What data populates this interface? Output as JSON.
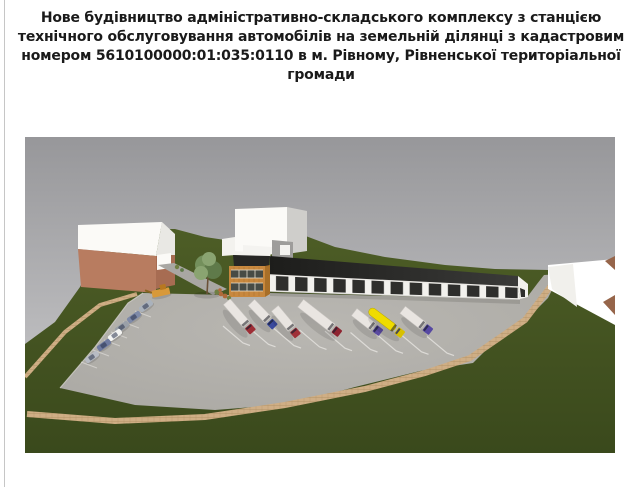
{
  "title": {
    "text": "Нове будівництво адміністративно-складського комплексу з станцією технічного обслуговування автомобілів на земельній ділянці з кадастровим номером 5610100000:01:035:0110 в м. Рівному, Рівненської територіальної громади",
    "lines": [
      "Нове будівництво адміністративно-складського комплексу з станцією",
      "технічного обслуговування автомобілів на земельній ділянці з кадастровим",
      "номером 5610100000:01:035:0110 в м. Рівному, Рівненської територіальної",
      "громади"
    ]
  },
  "render": {
    "description": "3D site visualization: administrative building with wooden facade, long warehouse with dark roof and dark gate panels, truck parking bays with seven trucks, car parking with six cars and a loader, neighboring white massing buildings, green landscaped slopes and paved paths",
    "vehicle_counts": {
      "trucks": 7,
      "cars": 6,
      "loaders": 1
    },
    "colors": {
      "sky_top": "#97979a",
      "sky_bottom": "#bfbfc1",
      "grass_top": "#4d5d26",
      "grass_bottom": "#3a491c",
      "lot_center": "#b9b7b2",
      "lot_edge": "#aaa8a3",
      "path_tan": "#cfae85",
      "path_joint": "#a8895e",
      "path_gray": "#a9a7a3",
      "curb_white": "#d3d1cc",
      "brick": "#b87c60",
      "brick_side": "#a76c52",
      "white_bldg": "#fbfaf7",
      "white_bldg_shade": "#cfcecb",
      "gray_bldg": "#9e9d9b",
      "admin_wood": "#c8883e",
      "admin_wood_side": "#a86f28",
      "roof_left": "#1d1d1b",
      "roof_right": "#3a3a38",
      "wall_white": "#f2f1ed",
      "panel_dark": "#2e2e2c",
      "window_dark": "#474b45",
      "tree_light": "#8aa471",
      "tree_mid": "#74905c",
      "tree_dark": "#5f7a4a",
      "trunk": "#6b5138",
      "shrub_rust": "#b06a3a",
      "shrub_green": "#6f7f42",
      "trailer": "#e9e5e1",
      "tanker": "#efdc00",
      "line_white": "#e2e0dc",
      "brown_wedge": "#96654a",
      "truck_cabs": [
        "#9e2e36",
        "#3a4a9e",
        "#a03038",
        "#8e2430",
        "#5a4aa0",
        "#d8c000",
        "#5648a2"
      ],
      "car_colors": [
        "#aab2bc",
        "#7e8aa8",
        "#9aa0a8",
        "#f4f4f2",
        "#6e7aa0",
        "#b8bcc4"
      ],
      "loader_color": "#d8993a"
    }
  }
}
